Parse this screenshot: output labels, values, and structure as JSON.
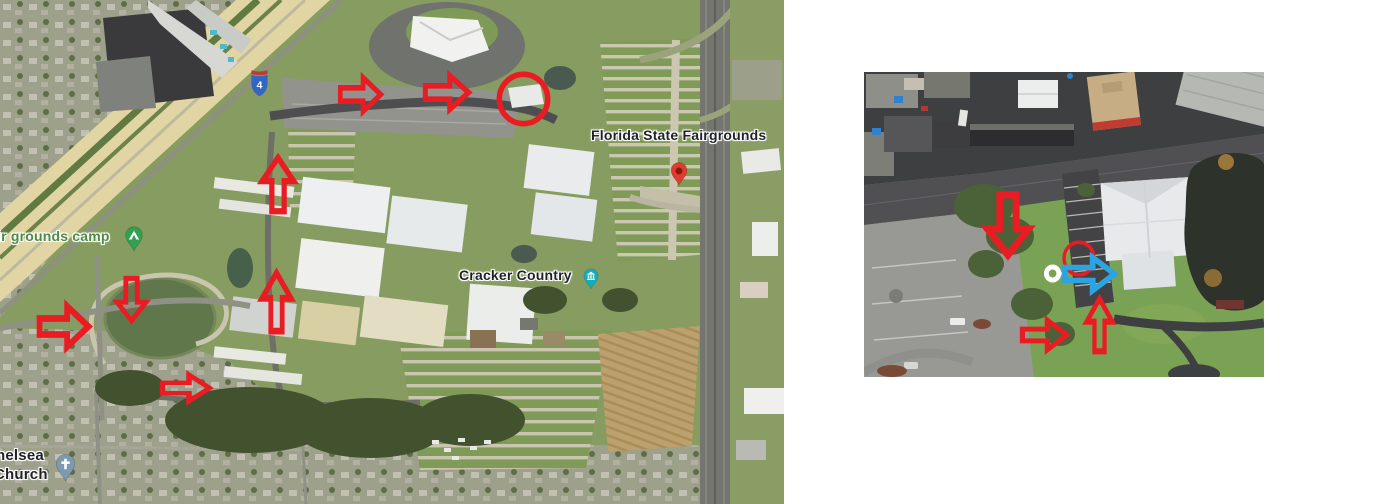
{
  "canvas": {
    "width": 1380,
    "height": 504,
    "background": "#ffffff"
  },
  "colors": {
    "red": "#ea1c23",
    "blue": "#2aa5e1",
    "white": "#ffffff"
  },
  "left_map": {
    "description": "satellite-overview-florida-state-fairgrounds",
    "x": 0,
    "y": 0,
    "w": 784,
    "h": 504,
    "labels": [
      {
        "id": "fairgrounds-label",
        "text": "Florida State Fairgrounds",
        "x": 591,
        "y": 128,
        "size": 14,
        "color": "#1f2125"
      },
      {
        "id": "cracker-country-label",
        "text": "Cracker Country",
        "x": 459,
        "y": 268,
        "size": 14,
        "color": "#1f2125"
      },
      {
        "id": "campground-label",
        "text": "ir grounds camp",
        "x": -3,
        "y": 229,
        "size": 14,
        "color": "#4e8a43"
      },
      {
        "id": "church-label-line1",
        "text": "helsea",
        "x": -4,
        "y": 448,
        "size": 15,
        "color": "#1f2125"
      },
      {
        "id": "church-label-line2",
        "text": "Church",
        "x": -6,
        "y": 467,
        "size": 15,
        "color": "#1f2125"
      }
    ],
    "shield": {
      "id": "interstate-4-shield",
      "text": "4",
      "x": 250,
      "y": 68,
      "w": 19,
      "h": 30,
      "body": "#3166c4",
      "band": "#c03a34"
    },
    "pins": [
      {
        "id": "fairgrounds-pin",
        "x": 670,
        "y": 161,
        "w": 18,
        "h": 27,
        "color": "#df3b2e",
        "glyph": "dot",
        "glyph_color": "#8c1711"
      },
      {
        "id": "cracker-country-pin",
        "x": 583,
        "y": 266,
        "w": 16,
        "h": 27,
        "color": "#13aebc",
        "glyph": "museum",
        "glyph_color": "#ffffff"
      },
      {
        "id": "campground-pin",
        "x": 124,
        "y": 226,
        "w": 20,
        "h": 27,
        "color": "#2fa14f",
        "glyph": "tent",
        "glyph_color": "#ffffff"
      },
      {
        "id": "church-pin",
        "x": 55,
        "y": 452,
        "w": 21,
        "h": 33,
        "color": "#7d9ab0",
        "glyph": "cross",
        "glyph_color": "#ffffff"
      }
    ],
    "annotations": [
      {
        "id": "route-arrow-top-1",
        "kind": "arrow",
        "dir": "right",
        "x": 339,
        "y": 74,
        "w": 43,
        "h": 41,
        "color": "red"
      },
      {
        "id": "route-arrow-top-2",
        "kind": "arrow",
        "dir": "right",
        "x": 424,
        "y": 72,
        "w": 46,
        "h": 41,
        "color": "red"
      },
      {
        "id": "destination-circle",
        "kind": "circle",
        "x": 496,
        "y": 71,
        "w": 55,
        "h": 56,
        "color": "red"
      },
      {
        "id": "route-arrow-up-1",
        "kind": "arrow",
        "dir": "up",
        "x": 259,
        "y": 156,
        "w": 38,
        "h": 57,
        "color": "red"
      },
      {
        "id": "route-arrow-up-2",
        "kind": "arrow",
        "dir": "up",
        "x": 259,
        "y": 271,
        "w": 35,
        "h": 62,
        "color": "red"
      },
      {
        "id": "route-arrow-down",
        "kind": "arrow",
        "dir": "down",
        "x": 114,
        "y": 277,
        "w": 35,
        "h": 45,
        "color": "red"
      },
      {
        "id": "route-arrow-left-edge",
        "kind": "arrow",
        "dir": "right",
        "x": 38,
        "y": 302,
        "w": 52,
        "h": 49,
        "color": "red"
      },
      {
        "id": "route-arrow-lake-south",
        "kind": "arrow",
        "dir": "right",
        "x": 161,
        "y": 372,
        "w": 50,
        "h": 32,
        "color": "red"
      }
    ]
  },
  "right_map": {
    "description": "satellite-detail-entrance-closeup",
    "x": 864,
    "y": 72,
    "w": 400,
    "h": 305,
    "labels": [],
    "pins": [],
    "annotations": [
      {
        "id": "detail-arrow-down",
        "kind": "arrow",
        "dir": "down",
        "x": 119,
        "y": 121,
        "w": 50,
        "h": 64,
        "color": "red"
      },
      {
        "id": "detail-ring-marker",
        "kind": "ring",
        "x": 179,
        "y": 189,
        "w": 24,
        "h": 25,
        "color": "white"
      },
      {
        "id": "detail-circle",
        "kind": "circle",
        "x": 198,
        "y": 168,
        "w": 34,
        "h": 37,
        "color": "red"
      },
      {
        "id": "detail-arrow-blue",
        "kind": "arrow",
        "dir": "right",
        "x": 199,
        "y": 182,
        "w": 53,
        "h": 40,
        "color": "blue"
      },
      {
        "id": "detail-arrow-right",
        "kind": "arrow",
        "dir": "right",
        "x": 157,
        "y": 245,
        "w": 47,
        "h": 36,
        "color": "red"
      },
      {
        "id": "detail-arrow-up",
        "kind": "arrow",
        "dir": "up",
        "x": 220,
        "y": 225,
        "w": 31,
        "h": 56,
        "color": "red"
      }
    ]
  }
}
